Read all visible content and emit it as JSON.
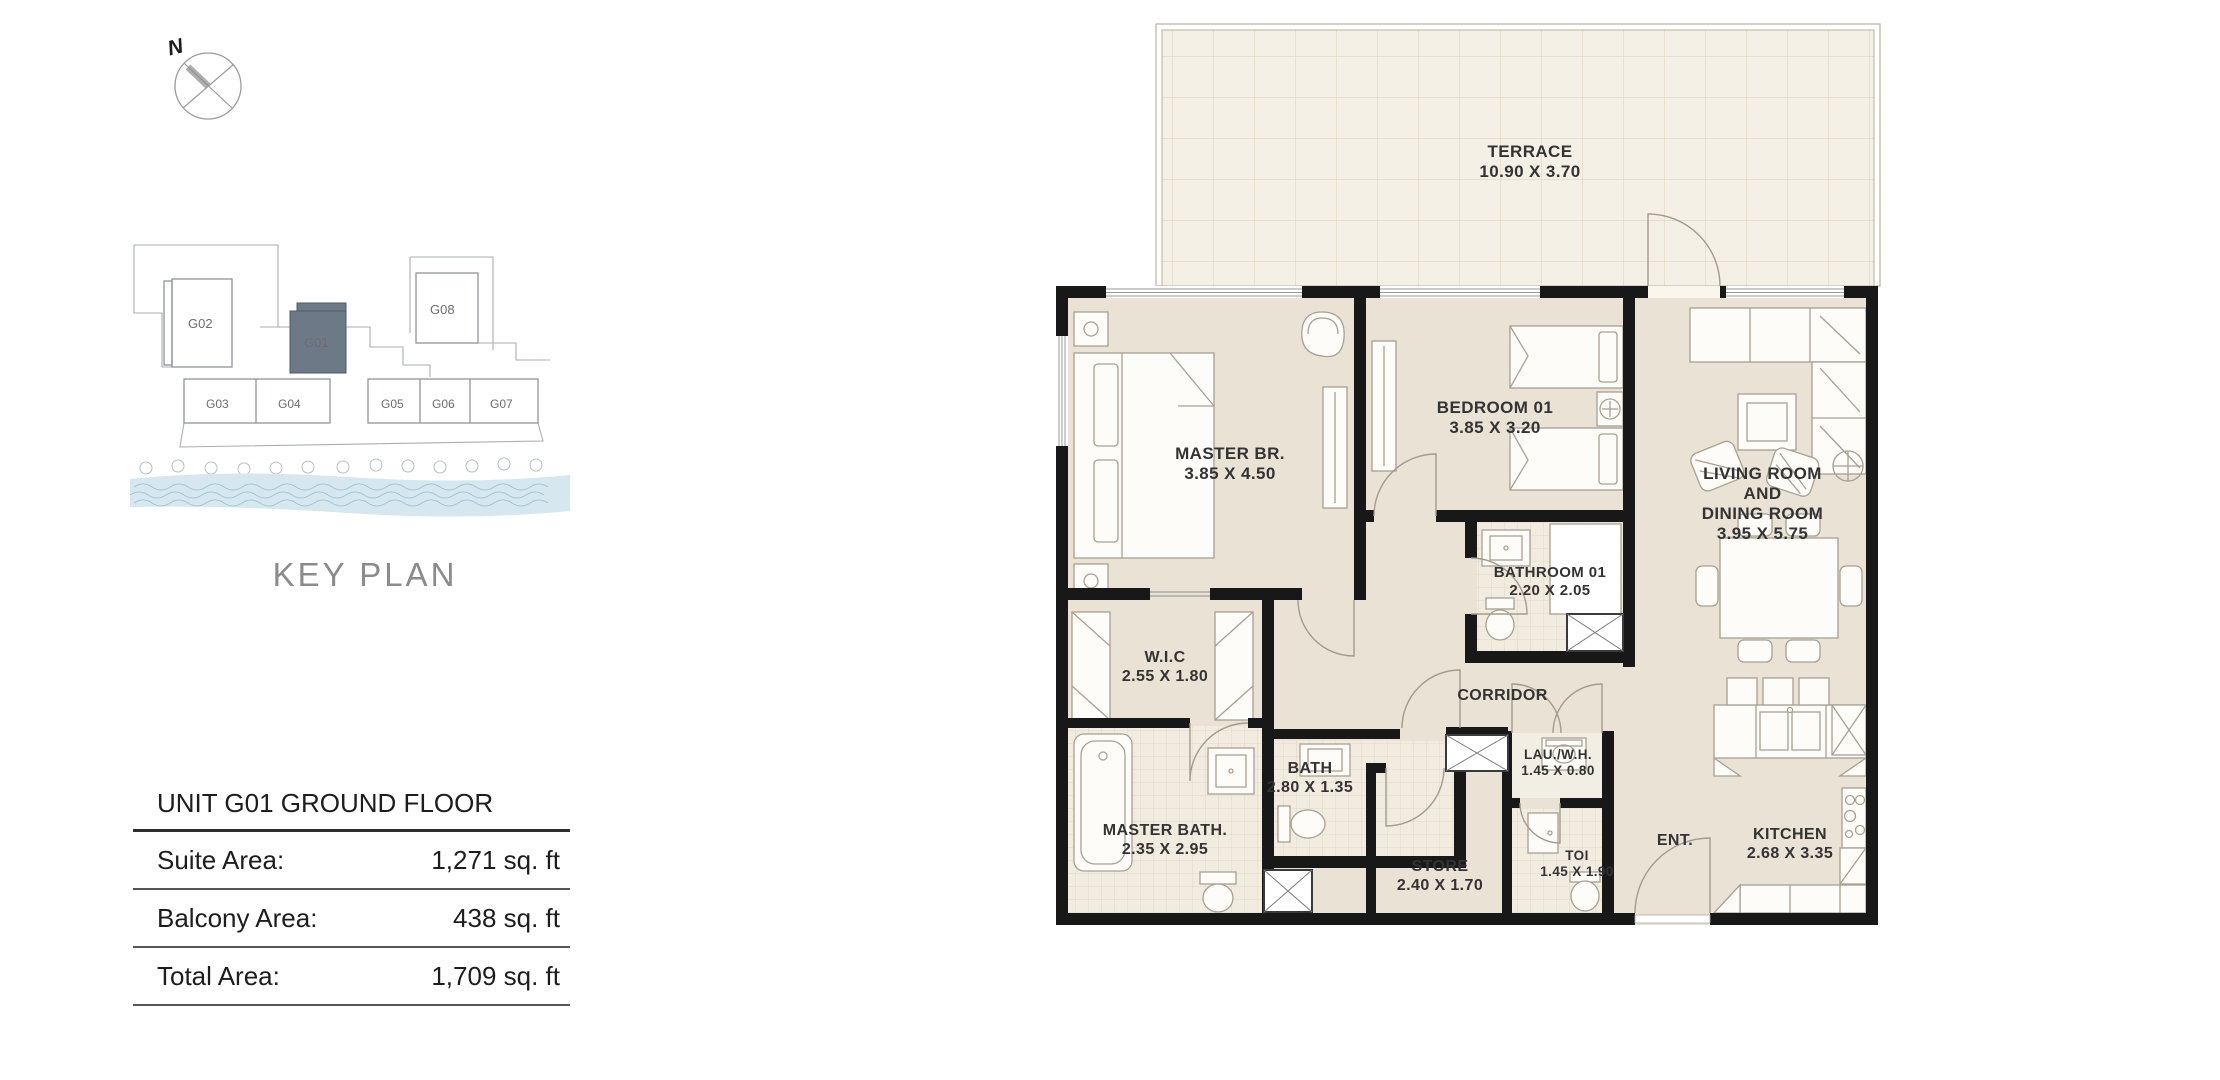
{
  "compass": {
    "north_label": "N"
  },
  "key_plan": {
    "caption": "KEY PLAN",
    "highlight_color": "#6e7987",
    "water_color": "#d6e7f0",
    "units": {
      "g01": "G01",
      "g02": "G02",
      "g03": "G03",
      "g04": "G04",
      "g05": "G05",
      "g06": "G06",
      "g07": "G07",
      "g08": "G08"
    }
  },
  "area_table": {
    "title": "UNIT G01 GROUND FLOOR",
    "rows": [
      {
        "label": "Suite Area:",
        "value": "1,271 sq. ft"
      },
      {
        "label": "Balcony Area:",
        "value": "438 sq. ft"
      },
      {
        "label": "Total Area:",
        "value": "1,709 sq. ft"
      }
    ]
  },
  "floor_plan": {
    "terrace": {
      "name": "TERRACE",
      "dims": "10.90 X 3.70"
    },
    "rooms": {
      "master_br": {
        "name": "MASTER BR.",
        "dims": "3.85 X 4.50"
      },
      "bedroom_01": {
        "name": "BEDROOM 01",
        "dims": "3.85 X 3.20"
      },
      "living_dining": {
        "name": [
          "LIVING ROOM",
          "AND",
          "DINING ROOM"
        ],
        "dims": "3.95 X 5.75"
      },
      "bathroom_01": {
        "name": "BATHROOM 01",
        "dims": "2.20 X 2.05"
      },
      "wic": {
        "name": "W.I.C",
        "dims": "2.55 X 1.80"
      },
      "corridor": {
        "name": "CORRIDOR"
      },
      "bath": {
        "name": "BATH",
        "dims": "2.80 X 1.35"
      },
      "master_bath": {
        "name": "MASTER BATH.",
        "dims": "2.35 X 2.95"
      },
      "store": {
        "name": "STORE",
        "dims": "2.40 X 1.70"
      },
      "laundry": {
        "name": "LAU./W.H.",
        "dims": "1.45 X 0.80"
      },
      "toi": {
        "name": "TOI",
        "dims": "1.45 X 1.90"
      },
      "entrance": {
        "name": "ENT."
      },
      "kitchen": {
        "name": "KITCHEN",
        "dims": "2.68 X 3.35"
      }
    }
  }
}
